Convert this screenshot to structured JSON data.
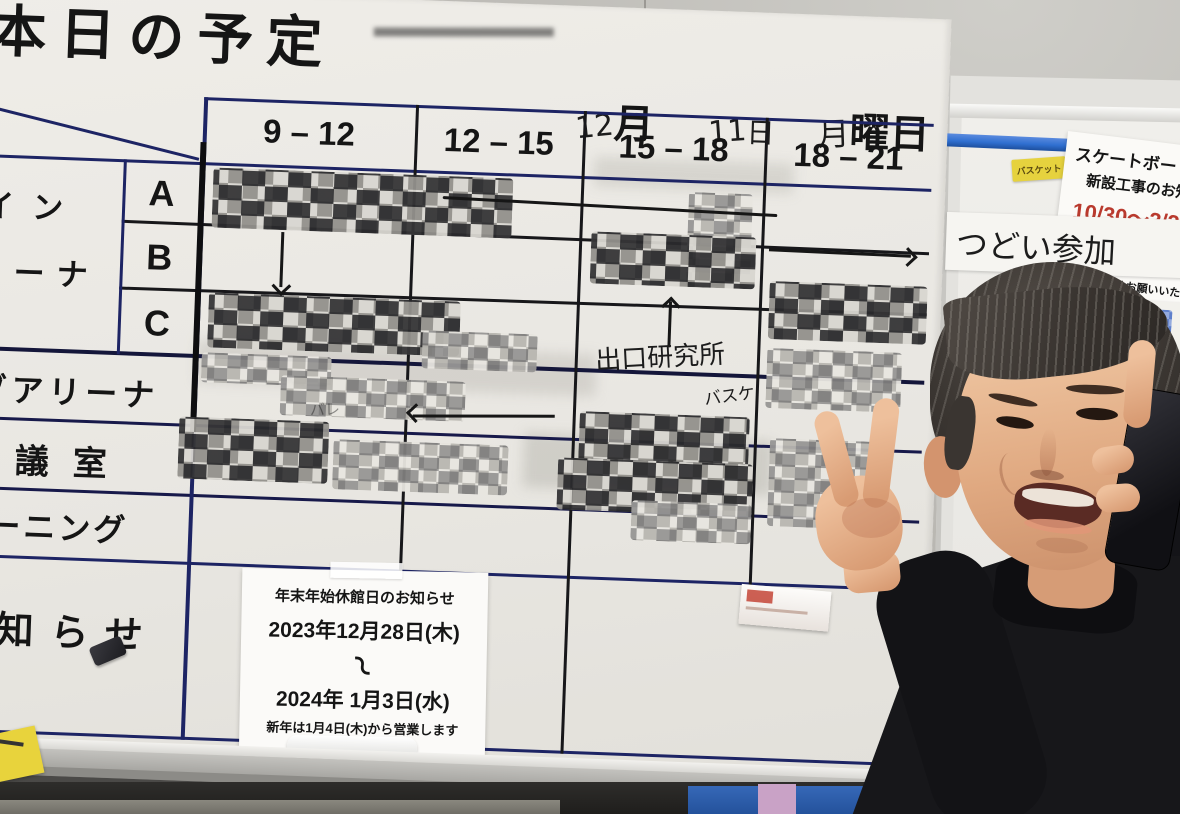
{
  "board": {
    "title": "本日の予定",
    "date": {
      "month": "12",
      "month_suffix": "月",
      "day": "11",
      "day_suffix": "日",
      "weekday_prefix": "月",
      "weekday_suffix": "曜日"
    },
    "time_slots": [
      "9 – 12",
      "12 – 15",
      "15 – 18",
      "18 – 21"
    ],
    "court_rows": [
      "A",
      "B",
      "C"
    ],
    "row_labels": {
      "main_arena_line1": "メイン",
      "main_arena_line2": "アリーナ",
      "sub_arena": "サブアリーナ",
      "meeting_room": "会議室",
      "training": "トレーニング",
      "notice": "お知らせ"
    },
    "handwriting": {
      "deguchi_lab": "出口研究所",
      "basket": "バスケ",
      "faint": "バレ"
    }
  },
  "holiday_notice": {
    "title": "年末年始休館日のお知らせ",
    "start": "2023年12月28日(木)",
    "range_mark": "〜",
    "end": "2024年 1月3日(水)",
    "note": "新年は1月4日(木)から営業します"
  },
  "side_board": {
    "basket_tag": "バスケット",
    "construction": {
      "line1": "スケートボード",
      "line2": "新設工事のお知",
      "period": "10/30〜3/3",
      "line3": "工事車両が通行いたします",
      "line4": "ご迷惑をおかけしますが、こ",
      "line5": "の程よろしくお願いいたします"
    },
    "tsudoi": "つどい参加",
    "partial_note_lines": [
      "月〜",
      "（",
      "止の　い",
      "どいの"
    ]
  },
  "colors": {
    "grid_navy": "#1d2464",
    "marker_black": "#141414",
    "red_text": "#b93a2e",
    "tag_yellow": "#e6d23e",
    "pen_blue": "#2f6fd0"
  }
}
